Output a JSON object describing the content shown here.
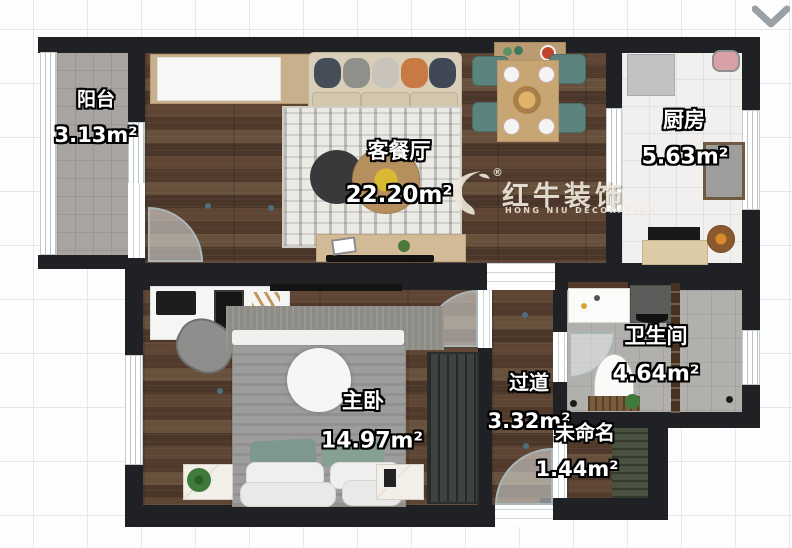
{
  "watermark": {
    "brand": "红牛装饰",
    "subtitle": "HONG NIU DECORATION",
    "registered": "®"
  },
  "rooms": {
    "balcony": {
      "name": "阳台",
      "area": "3.13m²"
    },
    "living_dining": {
      "name": "客餐厅",
      "area": "22.20m²"
    },
    "kitchen": {
      "name": "厨房",
      "area": "5.63m²"
    },
    "master_bedroom": {
      "name": "主卧",
      "area": "14.97m²"
    },
    "hallway": {
      "name": "过道",
      "area": "3.32m²"
    },
    "bathroom": {
      "name": "卫生间",
      "area": "4.64m²"
    },
    "unnamed": {
      "name": "未命名",
      "area": "1.44m²"
    }
  },
  "colors": {
    "wall": "#202124",
    "wood_floor": "#5b4334",
    "balcony_tile": "#a8a5a0",
    "bath_tile": "#b2b0ac",
    "kitchen_tile": "#f1f0ee",
    "chair_teal": "#5c847e",
    "watermark_text": "#eee7db",
    "accent_orange": "#c87a44"
  }
}
